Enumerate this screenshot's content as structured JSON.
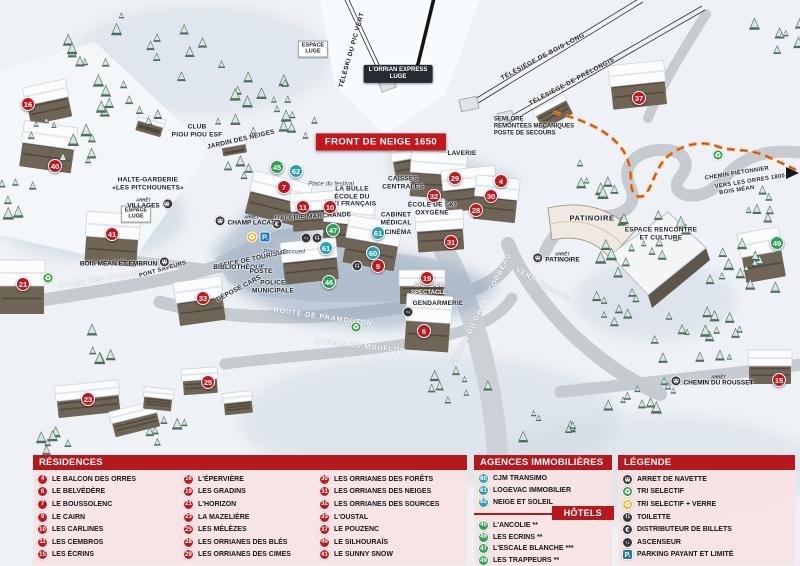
{
  "map": {
    "banner": "FRONT DE NEIGE 1650",
    "labels": [
      {
        "lines": [
          "TÉLÉSKI DU PIC VERT"
        ],
        "x": 352,
        "y": 50,
        "rot": -74,
        "cls": "lift"
      },
      {
        "lines": [
          "TÉLÉSIÈGE DE BOIS LONG"
        ],
        "x": 543,
        "y": 57,
        "rot": -28,
        "cls": "lift"
      },
      {
        "lines": [
          "TÉLÉSIÈGE DE PRÉLONGIS"
        ],
        "x": 572,
        "y": 82,
        "rot": -28,
        "cls": "lift"
      },
      {
        "lines": [
          "L'ORRIAN EXPRESS",
          "LUGE"
        ],
        "x": 398,
        "y": 74,
        "cls": "tag"
      },
      {
        "lines": [
          "ESPACE",
          "LUGE"
        ],
        "x": 313,
        "y": 49,
        "cls": "box"
      },
      {
        "lines": [
          "SEMLORE",
          "REMONTÉES MÉCANIQUES",
          "POSTE DE SECOURS"
        ],
        "x": 534,
        "y": 127,
        "cls": "facL"
      },
      {
        "lines": [
          "CLUB",
          "PIOU PIOU ESF"
        ],
        "x": 197,
        "y": 131,
        "cls": "fac"
      },
      {
        "lines": [
          "JARDIN DES NEIGES"
        ],
        "x": 241,
        "y": 140,
        "rot": -13,
        "cls": "fac"
      },
      {
        "lines": [
          "HALTE-GARDERIE",
          "«LES PITCHOUNETS»"
        ],
        "x": 148,
        "y": 184,
        "cls": "fac"
      },
      {
        "lines": [
          "ESPACE",
          "LUGE"
        ],
        "x": 136,
        "y": 214,
        "cls": "box"
      },
      {
        "lines": [
          "LAVERIE"
        ],
        "x": 462,
        "y": 154,
        "cls": "fac"
      },
      {
        "lines": [
          "CAISSES",
          "CENTRALES"
        ],
        "x": 403,
        "y": 183,
        "cls": "fac"
      },
      {
        "lines": [
          "LA BULLE",
          "ÉCOLE DU",
          "SKI FRANÇAIS"
        ],
        "x": 352,
        "y": 197,
        "cls": "fac"
      },
      {
        "lines": [
          "ÉCOLE DE SKI",
          "OXYGÈNE"
        ],
        "x": 432,
        "y": 209,
        "cls": "fac"
      },
      {
        "lines": [
          "CABINET",
          "MÉDICAL"
        ],
        "x": 396,
        "y": 219,
        "cls": "fac"
      },
      {
        "lines": [
          "CINÉMA"
        ],
        "x": 398,
        "y": 233,
        "cls": "fac"
      },
      {
        "lines": [
          "GALERIE MARCHANDE"
        ],
        "x": 313,
        "y": 217,
        "rot": -3,
        "cls": "fac"
      },
      {
        "lines": [
          "OFFICE DE TOURISME"
        ],
        "x": 251,
        "y": 260,
        "rot": -12,
        "cls": "fac"
      },
      {
        "lines": [
          "BIBLIOTHÈQUE"
        ],
        "x": 239,
        "y": 268,
        "cls": "fac"
      },
      {
        "lines": [
          "POSTE"
        ],
        "x": 261,
        "y": 272,
        "cls": "fac"
      },
      {
        "lines": [
          "POLICE",
          "MUNICIPALE"
        ],
        "x": 273,
        "y": 287,
        "cls": "fac"
      },
      {
        "lines": [
          "DÉPOSE CARS"
        ],
        "x": 239,
        "y": 289,
        "rot": -28,
        "cls": "fac"
      },
      {
        "lines": [
          "SALLE DE",
          "SPECTACLE"
        ],
        "x": 429,
        "y": 290,
        "cls": "facW"
      },
      {
        "lines": [
          "GENDARMERIE"
        ],
        "x": 438,
        "y": 304,
        "cls": "fac"
      },
      {
        "lines": [
          "PATINOIRE"
        ],
        "x": 592,
        "y": 219,
        "cls": "facB"
      },
      {
        "lines": [
          "ESPACE RENCONTRE",
          "ET CULTURE"
        ],
        "x": 661,
        "y": 234,
        "cls": "fac"
      },
      {
        "lines": [
          "Place d'accueil"
        ],
        "x": 284,
        "y": 252,
        "cls": "place"
      },
      {
        "lines": [
          "Place du festival"
        ],
        "x": 331,
        "y": 184,
        "cls": "place"
      },
      {
        "lines": [
          "ALLÉE DES CHAMOIS"
        ],
        "x": 103,
        "y": 280,
        "rot": -9,
        "cls": "road"
      },
      {
        "lines": [
          "PONT SAVEURS"
        ],
        "x": 163,
        "y": 270,
        "rot": -16,
        "cls": "roadDark"
      },
      {
        "lines": [
          "ROUTE DE PRAMOUTON"
        ],
        "x": 323,
        "y": 318,
        "rot": 8,
        "cls": "road"
      },
      {
        "lines": [
          "CHEMIN DU MOUFLON"
        ],
        "x": 360,
        "y": 347,
        "rot": 6,
        "cls": "road"
      },
      {
        "lines": [
          "CHEMIN DU GRAND CORBEAU"
        ],
        "x": 482,
        "y": 310,
        "rot": -63,
        "cls": "road"
      },
      {
        "lines": [
          "VERS EMBRUN →"
        ],
        "x": 547,
        "y": 288,
        "rot": 30,
        "cls": "road"
      },
      {
        "lines": [
          "CHEMIN PIÉTONNIER"
        ],
        "x": 737,
        "y": 174,
        "rot": -9,
        "cls": "roadDark"
      },
      {
        "lines": [
          "VERS LES ORRES 1800"
        ],
        "x": 750,
        "y": 182,
        "rot": -9,
        "cls": "roadDark"
      },
      {
        "lines": [
          "BOIS MÉAN"
        ],
        "x": 737,
        "y": 191,
        "rot": -9,
        "cls": "roadDark"
      }
    ],
    "bus_stops": [
      {
        "arret": "ARRÊT",
        "name": "VILLAGES",
        "x": 150,
        "y": 204,
        "side": "right"
      },
      {
        "arret": "ARRÊT",
        "name": "CHAMP LACAS",
        "x": 245,
        "y": 221,
        "side": "left"
      },
      {
        "arret": "ARRÊT",
        "name": "BOIS MÉAN ET EMBRUN",
        "x": 125,
        "y": 262,
        "side": "right"
      },
      {
        "arret": "ARRÊT",
        "name": "PATINOIRE",
        "x": 556,
        "y": 258,
        "side": "left"
      },
      {
        "arret": "ARRÊT",
        "name": "CHEMIN DU ROUSSET",
        "x": 712,
        "y": 381,
        "side": "left"
      }
    ],
    "markers": [
      {
        "n": "16",
        "x": 28,
        "y": 104,
        "t": "r"
      },
      {
        "n": "40",
        "x": 55,
        "y": 166,
        "t": "r"
      },
      {
        "n": "41",
        "x": 112,
        "y": 234,
        "t": "r"
      },
      {
        "n": "21",
        "x": 23,
        "y": 284,
        "t": "r"
      },
      {
        "n": "33",
        "x": 203,
        "y": 298,
        "t": "r"
      },
      {
        "n": "23",
        "x": 88,
        "y": 399,
        "t": "r"
      },
      {
        "n": "25",
        "x": 208,
        "y": 382,
        "t": "r"
      },
      {
        "n": "7",
        "x": 284,
        "y": 187,
        "t": "r"
      },
      {
        "n": "11",
        "x": 303,
        "y": 207,
        "t": "r"
      },
      {
        "n": "10",
        "x": 330,
        "y": 207,
        "t": "r"
      },
      {
        "n": "9",
        "x": 378,
        "y": 266,
        "t": "r"
      },
      {
        "n": "32",
        "x": 434,
        "y": 196,
        "t": "r"
      },
      {
        "n": "29",
        "x": 455,
        "y": 178,
        "t": "r"
      },
      {
        "n": "4",
        "x": 501,
        "y": 181,
        "t": "r"
      },
      {
        "n": "30",
        "x": 491,
        "y": 196,
        "t": "r"
      },
      {
        "n": "28",
        "x": 476,
        "y": 210,
        "t": "r"
      },
      {
        "n": "31",
        "x": 451,
        "y": 242,
        "t": "r"
      },
      {
        "n": "19",
        "x": 427,
        "y": 278,
        "t": "r"
      },
      {
        "n": "6",
        "x": 424,
        "y": 331,
        "t": "r"
      },
      {
        "n": "37",
        "x": 639,
        "y": 98,
        "t": "r"
      },
      {
        "n": "15",
        "x": 779,
        "y": 380,
        "t": "r"
      },
      {
        "n": "62",
        "x": 296,
        "y": 171,
        "t": "a"
      },
      {
        "n": "61",
        "x": 326,
        "y": 248,
        "t": "a"
      },
      {
        "n": "61",
        "x": 378,
        "y": 233,
        "t": "a"
      },
      {
        "n": "60",
        "x": 373,
        "y": 253,
        "t": "a"
      },
      {
        "n": "45",
        "x": 277,
        "y": 167,
        "t": "h"
      },
      {
        "n": "47",
        "x": 333,
        "y": 230,
        "t": "h"
      },
      {
        "n": "46",
        "x": 329,
        "y": 282,
        "t": "h"
      },
      {
        "n": "49",
        "x": 777,
        "y": 243,
        "t": "h"
      }
    ],
    "icons": [
      {
        "icon": "tri-verre",
        "x": 252,
        "y": 237
      },
      {
        "icon": "parking",
        "x": 265,
        "y": 237
      },
      {
        "icon": "euro",
        "x": 277,
        "y": 224
      },
      {
        "icon": "elevator",
        "x": 306,
        "y": 238
      },
      {
        "icon": "toilet",
        "x": 317,
        "y": 238
      },
      {
        "icon": "toilet",
        "x": 357,
        "y": 266
      },
      {
        "icon": "elevator",
        "x": 408,
        "y": 312
      },
      {
        "icon": "tri",
        "x": 48,
        "y": 278
      },
      {
        "icon": "tri",
        "x": 356,
        "y": 327
      },
      {
        "icon": "tri",
        "x": 718,
        "y": 155
      }
    ]
  },
  "legend": {
    "residences": {
      "title": "RÉSIDENCES",
      "col1": [
        {
          "num": "4",
          "name": "LE BALCON DES ORRES"
        },
        {
          "num": "6",
          "name": "LE BELVÉDÈRE"
        },
        {
          "num": "7",
          "name": "LE BOUSSOLENC"
        },
        {
          "num": "9",
          "name": "LE CAIRN"
        },
        {
          "num": "10",
          "name": "LES CARLINES"
        },
        {
          "num": "11",
          "name": "LES CEMBROS"
        },
        {
          "num": "15",
          "name": "LES ÉCRINS"
        }
      ],
      "col2": [
        {
          "num": "16",
          "name": "L'ÉPERVIÈRE"
        },
        {
          "num": "19",
          "name": "LES GRADINS"
        },
        {
          "num": "21",
          "name": "L'HORIZON"
        },
        {
          "num": "23",
          "name": "LA MAZELIÈRE"
        },
        {
          "num": "25",
          "name": "LES MÉLÈZES"
        },
        {
          "num": "28",
          "name": "LES ORRIANES DES BLÉS"
        },
        {
          "num": "29",
          "name": "LES ORRIANES DES CIMES"
        }
      ],
      "col3": [
        {
          "num": "30",
          "name": "LES ORRIANES DES FORÊTS"
        },
        {
          "num": "31",
          "name": "LES ORRIANES DES NEIGES"
        },
        {
          "num": "32",
          "name": "LES ORRIANES DES SOURCES"
        },
        {
          "num": "33",
          "name": "L'OUSTAL"
        },
        {
          "num": "37",
          "name": "LE POUZENC"
        },
        {
          "num": "40",
          "name": "LE SILHOURAÏS"
        },
        {
          "num": "41",
          "name": "LE SUNNY SNOW"
        }
      ]
    },
    "agences": {
      "title": "AGENCES IMMOBILIÈRES",
      "items": [
        {
          "num": "60",
          "name": "CJM TRANSIMO"
        },
        {
          "num": "61",
          "name": "LOGEVAC IMMOBILIER"
        },
        {
          "num": "62",
          "name": "NEIGE ET SOLEIL"
        }
      ]
    },
    "hotels": {
      "title": "HÔTELS",
      "items": [
        {
          "num": "45",
          "name": "L'ANCOLIE **"
        },
        {
          "num": "46",
          "name": "LES ECRINS **"
        },
        {
          "num": "47",
          "name": "L'ESCALE BLANCHE ***"
        },
        {
          "num": "49",
          "name": "LES TRAPPEURS **"
        }
      ]
    },
    "legende": {
      "title": "LÉGENDE",
      "items": [
        {
          "icon": "bus",
          "label": "ARRET DE NAVETTE"
        },
        {
          "icon": "tri",
          "label": "TRI SELECTIF"
        },
        {
          "icon": "tri-verre",
          "label": "TRI SELECTIF + VERRE"
        },
        {
          "icon": "toilet",
          "label": "TOILETTE"
        },
        {
          "icon": "euro",
          "label": "DISTRIBUTEUR DE BILLETS"
        },
        {
          "icon": "elevator",
          "label": "ASCENSEUR"
        },
        {
          "icon": "parking",
          "label": "PARKING PAYANT ET LIMITÉ"
        }
      ]
    }
  },
  "colors": {
    "residence": "#c3161d",
    "agence": "#2b9fb0",
    "hotel": "#2aa257",
    "header": "#b5191e",
    "parking": "#1c79c0",
    "path": "#f08c1e"
  }
}
